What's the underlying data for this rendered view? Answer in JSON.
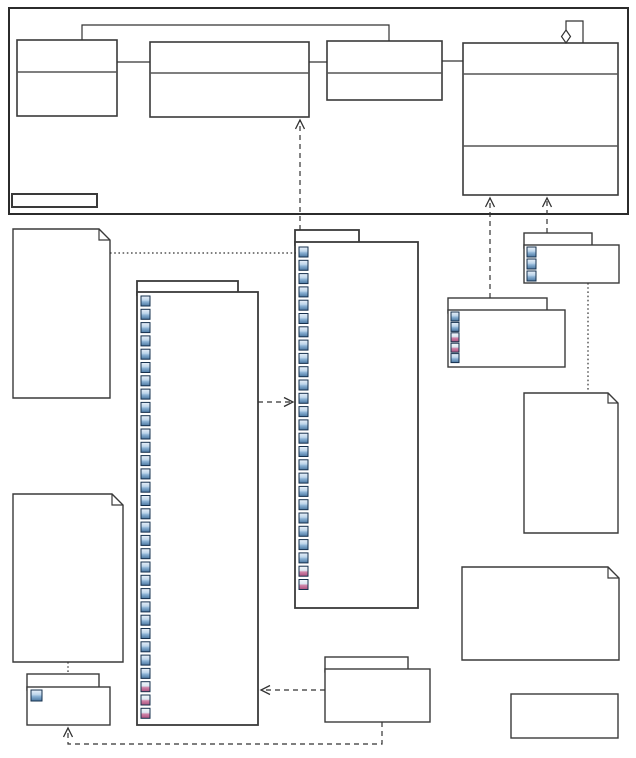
{
  "canvas": {
    "width": 636,
    "height": 758,
    "background": "#ffffff"
  },
  "palette": {
    "line": "#333333",
    "node_border": "#3a3a3a",
    "node_fill": "#ffffff",
    "divider": "#555555",
    "frame_border": "#2b2b2b",
    "icon_border": "#16304d",
    "icon_blue_stops": [
      "#e9f1fa",
      "#bdd5ea",
      "#8ab1d4",
      "#4a769f"
    ],
    "icon_pink_stops": [
      "#f3f7fb",
      "#dde8f2",
      "#d083a8",
      "#aa517e"
    ]
  },
  "diagram": {
    "frame": {
      "name": "package-frame",
      "x": 9,
      "y": 8,
      "w": 619,
      "h": 206,
      "sw": 2
    },
    "plain_rects": [
      {
        "name": "frame-name-box",
        "x": 12,
        "y": 194,
        "w": 85,
        "h": 13,
        "sw": 2
      },
      {
        "name": "bottom-right-box",
        "x": 511,
        "y": 694,
        "w": 107,
        "h": 44,
        "sw": 1.4
      }
    ],
    "classes": [
      {
        "name": "class-node-1",
        "x": 17,
        "y": 40,
        "w": 100,
        "h": 76,
        "dividers": [
          32
        ]
      },
      {
        "name": "class-node-2",
        "x": 150,
        "y": 42,
        "w": 159,
        "h": 75,
        "dividers": [
          31
        ]
      },
      {
        "name": "class-node-3",
        "x": 327,
        "y": 41,
        "w": 115,
        "h": 59,
        "dividers": [
          32
        ]
      },
      {
        "name": "class-node-4",
        "x": 463,
        "y": 43,
        "w": 155,
        "h": 152,
        "dividers": [
          31,
          103
        ]
      }
    ],
    "packages": [
      {
        "name": "package-node-a",
        "tab": [
          137,
          281,
          101,
          11
        ],
        "body": [
          137,
          292,
          121,
          433
        ],
        "sw": 1.8,
        "icons": {
          "x": 141,
          "y": 296,
          "step": 13.3,
          "w": 9,
          "h": 10,
          "pattern": [
            [
              "blue",
              29
            ],
            [
              "pink",
              3
            ]
          ]
        }
      },
      {
        "name": "package-node-b",
        "tab": [
          295,
          230,
          64,
          12
        ],
        "body": [
          295,
          242,
          123,
          366
        ],
        "sw": 1.8,
        "icons": {
          "x": 299,
          "y": 247,
          "step": 13.3,
          "w": 9,
          "h": 10,
          "pattern": [
            [
              "blue",
              24
            ],
            [
              "pink",
              2
            ]
          ]
        }
      },
      {
        "name": "package-node-c",
        "tab": [
          524,
          233,
          68,
          12
        ],
        "body": [
          524,
          245,
          95,
          38
        ],
        "sw": 1.4,
        "icons": {
          "x": 527,
          "y": 247,
          "step": 12,
          "w": 9,
          "h": 10,
          "pattern": [
            [
              "blue",
              3
            ]
          ]
        }
      },
      {
        "name": "package-node-d",
        "tab": [
          448,
          298,
          99,
          12
        ],
        "body": [
          448,
          310,
          117,
          57
        ],
        "sw": 1.4,
        "icons": {
          "x": 451,
          "y": 312,
          "step": 10.4,
          "w": 8,
          "h": 9,
          "pattern": [
            [
              "blue",
              2
            ],
            [
              "pink",
              2
            ],
            [
              "blue",
              1
            ]
          ]
        }
      },
      {
        "name": "package-node-e",
        "tab": [
          27,
          674,
          72,
          13
        ],
        "body": [
          27,
          687,
          83,
          38
        ],
        "sw": 1.4,
        "icons": {
          "x": 31,
          "y": 690,
          "step": 14,
          "w": 11,
          "h": 11,
          "pattern": [
            [
              "blue",
              1
            ]
          ]
        }
      },
      {
        "name": "package-node-f",
        "tab": [
          325,
          657,
          83,
          12
        ],
        "body": [
          325,
          669,
          105,
          53
        ],
        "sw": 1.4
      }
    ],
    "notes": [
      {
        "name": "note-node-1",
        "x": 13,
        "y": 229,
        "w": 97,
        "h": 169,
        "fold": 11
      },
      {
        "name": "note-node-2",
        "x": 524,
        "y": 393,
        "w": 94,
        "h": 140,
        "fold": 10
      },
      {
        "name": "note-node-3",
        "x": 13,
        "y": 494,
        "w": 110,
        "h": 168,
        "fold": 11
      },
      {
        "name": "note-node-4",
        "x": 462,
        "y": 567,
        "w": 157,
        "h": 93,
        "fold": 11
      }
    ],
    "connectors": [
      {
        "name": "association-class1-class2",
        "style": "solid",
        "points": [
          [
            117,
            62
          ],
          [
            150,
            62
          ]
        ]
      },
      {
        "name": "association-class2-class3",
        "style": "solid",
        "points": [
          [
            309,
            62
          ],
          [
            327,
            62
          ]
        ]
      },
      {
        "name": "association-class3-class4",
        "style": "solid",
        "points": [
          [
            442,
            61
          ],
          [
            463,
            61
          ]
        ]
      },
      {
        "name": "association-class1-class3-top",
        "style": "solid",
        "points": [
          [
            82,
            40
          ],
          [
            82,
            25
          ],
          [
            389,
            25
          ],
          [
            389,
            41
          ]
        ]
      },
      {
        "name": "aggregation-self-loop-class4",
        "style": "solid",
        "points": [
          [
            583,
            43
          ],
          [
            583,
            21
          ],
          [
            566,
            21
          ],
          [
            566,
            30
          ]
        ],
        "diamond": [
          566,
          36.5
        ]
      },
      {
        "name": "dependency-packageB-class2",
        "style": "dashed",
        "points": [
          [
            300,
            230
          ],
          [
            300,
            120
          ]
        ],
        "end": "arrow"
      },
      {
        "name": "dependency-packageD-class4",
        "style": "dashed",
        "points": [
          [
            490,
            298
          ],
          [
            490,
            198
          ]
        ],
        "end": "arrow"
      },
      {
        "name": "dependency-packageC-class4",
        "style": "dashed",
        "points": [
          [
            547,
            233
          ],
          [
            547,
            198
          ]
        ],
        "end": "arrow"
      },
      {
        "name": "dependency-packageA-packageB",
        "style": "dashed",
        "points": [
          [
            258,
            402
          ],
          [
            293,
            402
          ]
        ],
        "end": "arrow"
      },
      {
        "name": "dependency-packageF-packageA",
        "style": "dashed",
        "points": [
          [
            325,
            690
          ],
          [
            261,
            690
          ]
        ],
        "end": "arrow"
      },
      {
        "name": "dependency-packageF-packageE",
        "style": "dashed",
        "points": [
          [
            382,
            722
          ],
          [
            382,
            744
          ],
          [
            68,
            744
          ],
          [
            68,
            728
          ]
        ],
        "end": "arrow"
      },
      {
        "name": "note-anchor-note1-packageB",
        "style": "dotted",
        "points": [
          [
            110,
            253
          ],
          [
            296,
            253
          ]
        ]
      },
      {
        "name": "note-anchor-packageC-note2",
        "style": "dotted",
        "points": [
          [
            588,
            283
          ],
          [
            588,
            392
          ]
        ]
      },
      {
        "name": "note-anchor-note3-packageE",
        "style": "dotted",
        "points": [
          [
            68,
            662
          ],
          [
            68,
            673
          ]
        ]
      }
    ]
  }
}
